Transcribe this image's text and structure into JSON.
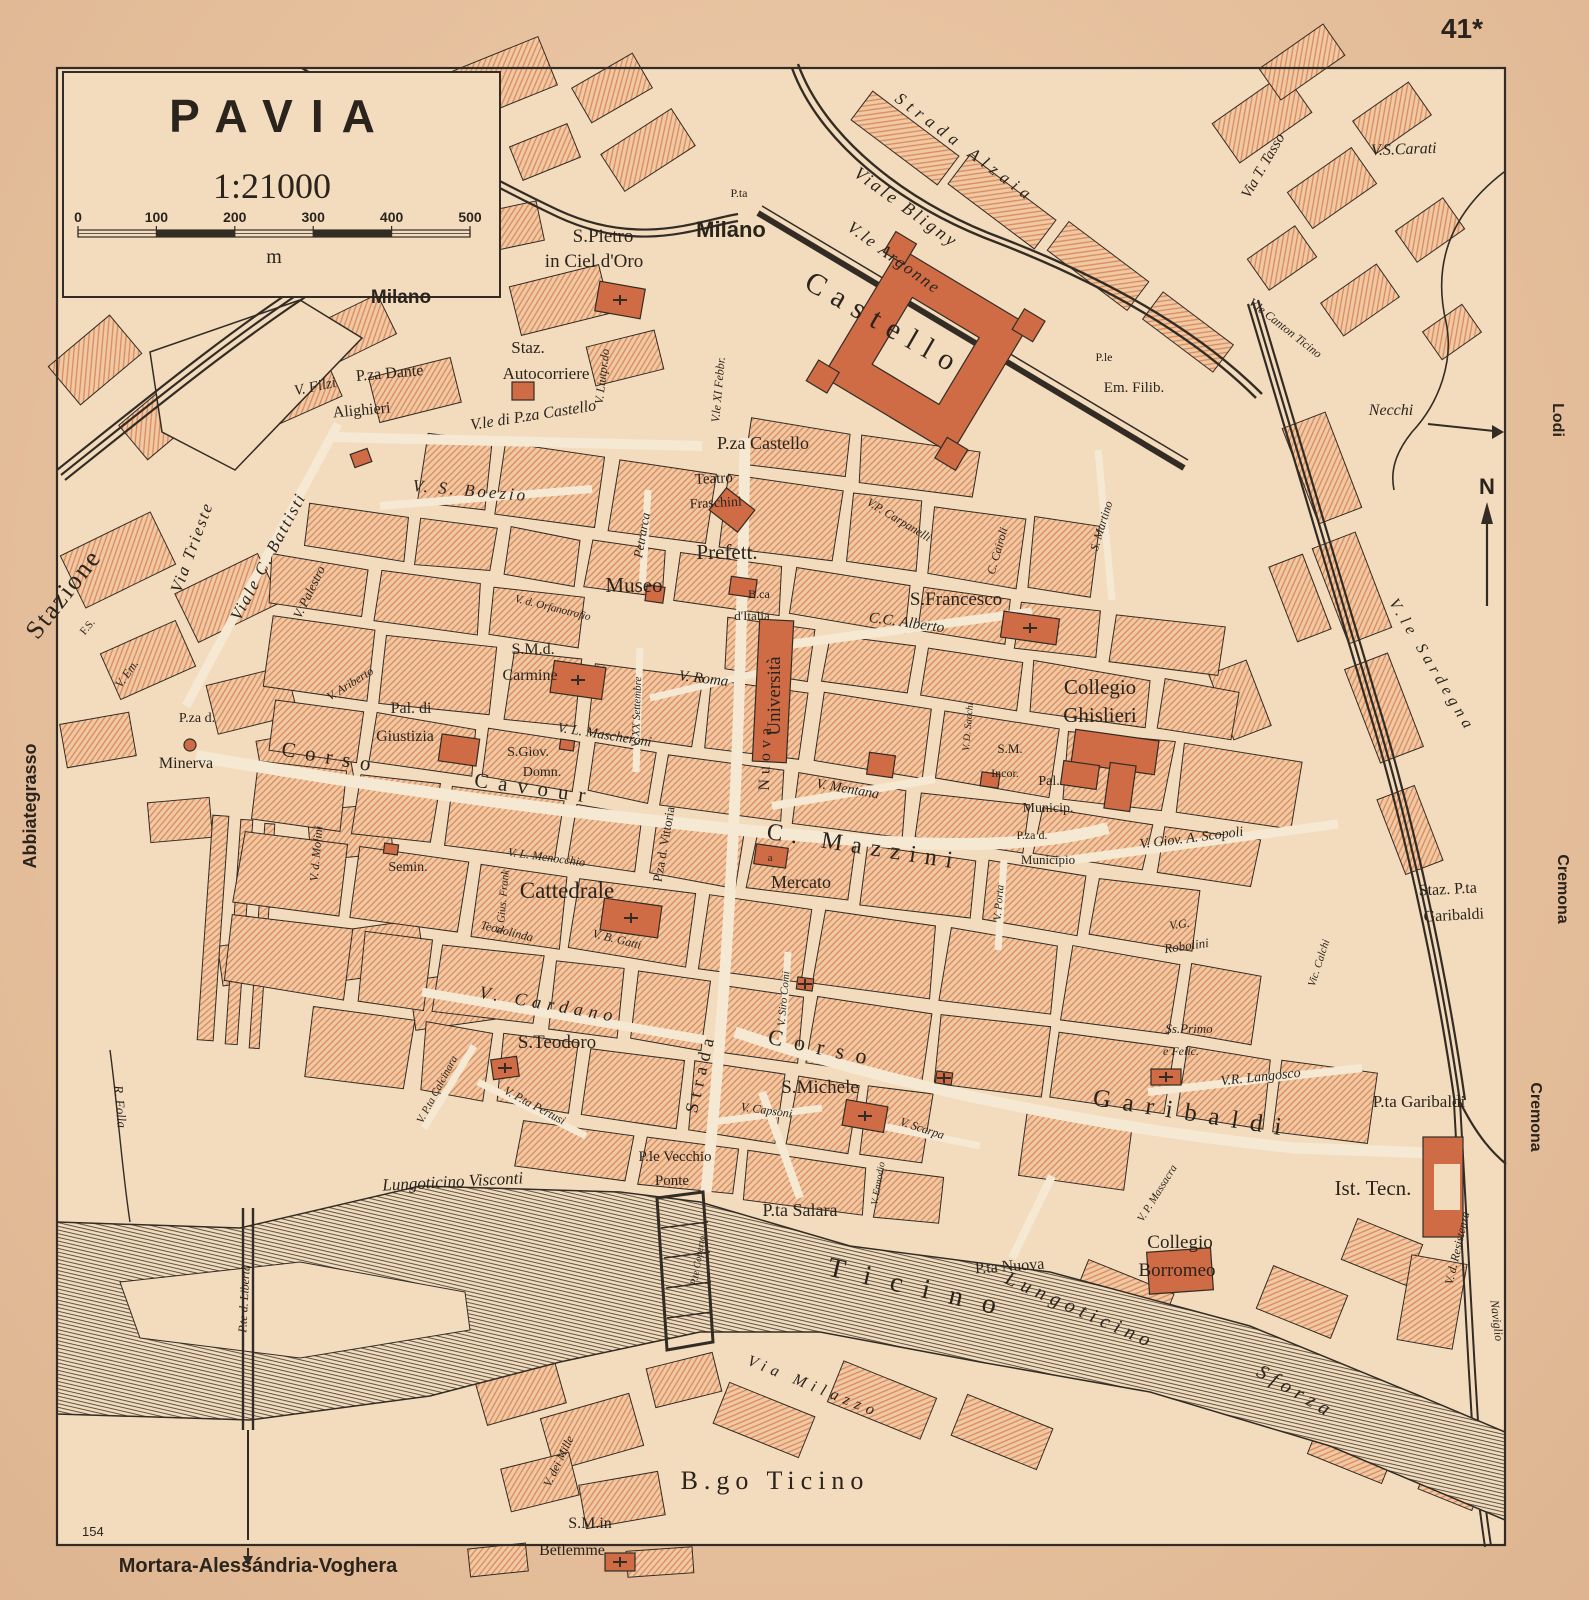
{
  "page": {
    "number": "41*",
    "plate": "154",
    "bottom_caption": "Mortara-Alessándria-Voghera"
  },
  "title_box": {
    "city": "PAVIA",
    "scale": "1:21000",
    "unit": "m",
    "ticks": [
      "0",
      "100",
      "200",
      "300",
      "400",
      "500"
    ]
  },
  "compass": {
    "north": "N"
  },
  "colors": {
    "paper": "#ecc4a0",
    "map_bg": "#f3dcbe",
    "street": "#f6e9d4",
    "block_fill": "#f0c9a4",
    "block_hatch": "#d98a5c",
    "building": "#cf6c46",
    "ink": "#332c24",
    "water_line": "#4a4236"
  },
  "map_labels": [
    {
      "t": "S.Pietro",
      "x": 603,
      "y": 242,
      "s": 19,
      "c": "place"
    },
    {
      "t": "in Ciel d'Oro",
      "x": 594,
      "y": 267,
      "s": 19,
      "c": "place"
    },
    {
      "t": "P.ta",
      "x": 739,
      "y": 197,
      "s": 12,
      "c": "place"
    },
    {
      "t": "Milano",
      "x": 731,
      "y": 237,
      "s": 22,
      "c": "exit"
    },
    {
      "t": "Strada Alzaia",
      "x": 962,
      "y": 152,
      "r": 37,
      "s": 17,
      "c": "street",
      "ls": 6
    },
    {
      "t": "Viale Bligny",
      "x": 903,
      "y": 212,
      "r": 36,
      "s": 18,
      "c": "street",
      "ls": 3
    },
    {
      "t": "V.le Argonne",
      "x": 891,
      "y": 262,
      "r": 36,
      "s": 17,
      "c": "street",
      "ls": 2
    },
    {
      "t": "Castello",
      "x": 880,
      "y": 332,
      "r": 30,
      "s": 30,
      "c": "place",
      "ls": 10
    },
    {
      "t": "V. Liutpr.do",
      "x": 606,
      "y": 377,
      "r": -83,
      "s": 12,
      "c": "street"
    },
    {
      "t": "V.le XI Febbr.",
      "x": 722,
      "y": 390,
      "r": -85,
      "s": 12,
      "c": "street"
    },
    {
      "t": "Staz.",
      "x": 528,
      "y": 353,
      "s": 17,
      "c": "place"
    },
    {
      "t": "Autocorriere",
      "x": 546,
      "y": 379,
      "s": 17,
      "c": "place"
    },
    {
      "t": "P.za Dante",
      "x": 390,
      "y": 378,
      "r": -5,
      "s": 16,
      "c": "place"
    },
    {
      "t": "Alighieri",
      "x": 362,
      "y": 415,
      "r": -5,
      "s": 16,
      "c": "place"
    },
    {
      "t": "V. Filzi",
      "x": 316,
      "y": 391,
      "r": -12,
      "s": 15,
      "c": "street"
    },
    {
      "t": "V.le di P.za Castello",
      "x": 534,
      "y": 420,
      "r": -9,
      "s": 16,
      "c": "street"
    },
    {
      "t": "P.za Castello",
      "x": 763,
      "y": 449,
      "s": 18,
      "c": "place"
    },
    {
      "t": "P.le",
      "x": 1104,
      "y": 361,
      "s": 12,
      "c": "place"
    },
    {
      "t": "Em. Filib.",
      "x": 1134,
      "y": 392,
      "s": 15,
      "c": "place"
    },
    {
      "t": "V.S.Carati",
      "x": 1404,
      "y": 154,
      "r": -2,
      "s": 16,
      "c": "street"
    },
    {
      "t": "Via T. Tasso",
      "x": 1267,
      "y": 168,
      "r": -60,
      "s": 15,
      "c": "street"
    },
    {
      "t": "V.le Canton Ticino",
      "x": 1283,
      "y": 331,
      "r": 38,
      "s": 12,
      "c": "street"
    },
    {
      "t": "Necchi",
      "x": 1391,
      "y": 415,
      "s": 16,
      "c": "street"
    },
    {
      "t": "Via Trieste",
      "x": 197,
      "y": 549,
      "r": -70,
      "s": 17,
      "c": "street",
      "ls": 2
    },
    {
      "t": "Stazione",
      "x": 70,
      "y": 599,
      "r": -52,
      "s": 26,
      "c": "place",
      "ls": 2
    },
    {
      "t": "F.S.",
      "x": 90,
      "y": 629,
      "r": -50,
      "s": 11,
      "c": "place"
    },
    {
      "t": "Viale C. Battisti",
      "x": 273,
      "y": 559,
      "r": -62,
      "s": 17,
      "c": "street",
      "ls": 2
    },
    {
      "t": "V. Palestro",
      "x": 313,
      "y": 594,
      "r": -64,
      "s": 13,
      "c": "street"
    },
    {
      "t": "V. S. Boezio",
      "x": 470,
      "y": 496,
      "r": 5,
      "s": 17,
      "c": "street",
      "ls": 3
    },
    {
      "t": "Teatro",
      "x": 714,
      "y": 483,
      "r": -3,
      "s": 15,
      "c": "place"
    },
    {
      "t": "Fraschini",
      "x": 716,
      "y": 507,
      "r": -3,
      "s": 14,
      "c": "place"
    },
    {
      "t": "Prefett.",
      "x": 727,
      "y": 559,
      "s": 21,
      "c": "place"
    },
    {
      "t": "Museo",
      "x": 634,
      "y": 592,
      "s": 21,
      "c": "place"
    },
    {
      "t": "B.ca",
      "x": 759,
      "y": 598,
      "s": 12,
      "c": "place"
    },
    {
      "t": "d'Italia",
      "x": 752,
      "y": 620,
      "s": 13,
      "c": "place"
    },
    {
      "t": "Petrarca",
      "x": 646,
      "y": 536,
      "r": -80,
      "s": 13,
      "c": "street"
    },
    {
      "t": "V.P. Carpanelli",
      "x": 897,
      "y": 523,
      "r": 31,
      "s": 12,
      "c": "street"
    },
    {
      "t": "C. Cairoli",
      "x": 1001,
      "y": 552,
      "r": -74,
      "s": 12,
      "c": "street"
    },
    {
      "t": "S.Francesco",
      "x": 956,
      "y": 605,
      "s": 19,
      "c": "place"
    },
    {
      "t": "C.C. Alberto",
      "x": 906,
      "y": 627,
      "r": 8,
      "s": 15,
      "c": "street"
    },
    {
      "t": "S. Martino",
      "x": 1105,
      "y": 527,
      "r": -73,
      "s": 12,
      "c": "street"
    },
    {
      "t": "Collegio",
      "x": 1100,
      "y": 694,
      "s": 21,
      "c": "place"
    },
    {
      "t": "Ghislieri",
      "x": 1100,
      "y": 722,
      "s": 21,
      "c": "place"
    },
    {
      "t": "V.le Sardegna",
      "x": 1428,
      "y": 668,
      "r": 59,
      "s": 16,
      "c": "street",
      "ls": 5
    },
    {
      "t": "Università",
      "x": 780,
      "y": 696,
      "r": -90,
      "s": 19,
      "c": "place"
    },
    {
      "t": "V. Roma",
      "x": 703,
      "y": 683,
      "r": 7,
      "s": 15,
      "c": "street"
    },
    {
      "t": "V. XX Settembre",
      "x": 640,
      "y": 712,
      "r": -88,
      "s": 11,
      "c": "street"
    },
    {
      "t": "S.M.d.",
      "x": 533,
      "y": 654,
      "s": 16,
      "c": "place"
    },
    {
      "t": "Carmine",
      "x": 530,
      "y": 680,
      "s": 16,
      "c": "place"
    },
    {
      "t": "V. L. Mascheroni",
      "x": 604,
      "y": 739,
      "r": 9,
      "s": 14,
      "c": "street"
    },
    {
      "t": "Pal. di",
      "x": 411,
      "y": 713,
      "s": 16,
      "c": "place"
    },
    {
      "t": "Giustizia",
      "x": 405,
      "y": 741,
      "s": 16,
      "c": "place"
    },
    {
      "t": "S.Giov.",
      "x": 528,
      "y": 756,
      "s": 14,
      "c": "place"
    },
    {
      "t": "Domn.",
      "x": 542,
      "y": 776,
      "s": 14,
      "c": "place"
    },
    {
      "t": "V. Ariberto",
      "x": 352,
      "y": 687,
      "r": -32,
      "s": 12,
      "c": "street"
    },
    {
      "t": "V. d. Molini",
      "x": 320,
      "y": 854,
      "r": -85,
      "s": 12,
      "c": "street"
    },
    {
      "t": "Corso",
      "x": 330,
      "y": 764,
      "r": 10,
      "s": 21,
      "c": "place",
      "ls": 10
    },
    {
      "t": "Cavour",
      "x": 534,
      "y": 795,
      "r": 8,
      "s": 21,
      "c": "place",
      "ls": 10
    },
    {
      "t": "P.za d.",
      "x": 197,
      "y": 722,
      "s": 14,
      "c": "place"
    },
    {
      "t": "Minerva",
      "x": 186,
      "y": 768,
      "s": 16,
      "c": "place"
    },
    {
      "t": "V. Em.",
      "x": 130,
      "y": 676,
      "r": -55,
      "s": 12,
      "c": "street"
    },
    {
      "t": "Abbiategrasso",
      "x": 36,
      "y": 806,
      "r": -90,
      "s": 18,
      "c": "exit"
    },
    {
      "t": "V. Gius. Frank",
      "x": 506,
      "y": 902,
      "r": -85,
      "s": 11,
      "c": "street"
    },
    {
      "t": "V. L. Menocchio",
      "x": 546,
      "y": 861,
      "r": 8,
      "s": 12,
      "c": "street"
    },
    {
      "t": "Semin.",
      "x": 408,
      "y": 871,
      "s": 14,
      "c": "place"
    },
    {
      "t": "Cattedrale",
      "x": 567,
      "y": 898,
      "s": 23,
      "c": "place"
    },
    {
      "t": "Teodolinda",
      "x": 506,
      "y": 935,
      "r": 14,
      "s": 12,
      "c": "street"
    },
    {
      "t": "V. B. Gatti",
      "x": 616,
      "y": 943,
      "r": 14,
      "s": 12,
      "c": "street"
    },
    {
      "t": "P.za d. Vittoria",
      "x": 668,
      "y": 845,
      "r": -80,
      "s": 13,
      "c": "place"
    },
    {
      "t": "V. Mentana",
      "x": 847,
      "y": 793,
      "r": 10,
      "s": 14,
      "c": "street"
    },
    {
      "t": "C. Mazzini",
      "x": 863,
      "y": 854,
      "r": 9,
      "s": 24,
      "c": "place",
      "ls": 9
    },
    {
      "t": "Mercato",
      "x": 801,
      "y": 888,
      "s": 18,
      "c": "place"
    },
    {
      "t": "a",
      "x": 770,
      "y": 861,
      "s": 11,
      "c": "place",
      "col": "#f6e9d4"
    },
    {
      "t": "V. Siro Comi",
      "x": 787,
      "y": 999,
      "r": -85,
      "s": 11,
      "c": "street"
    },
    {
      "t": "V. Porta",
      "x": 1002,
      "y": 903,
      "r": -85,
      "s": 11,
      "c": "street"
    },
    {
      "t": "S.M.",
      "x": 1010,
      "y": 753,
      "s": 13,
      "c": "place"
    },
    {
      "t": "Incor.",
      "x": 1005,
      "y": 777,
      "s": 12,
      "c": "place"
    },
    {
      "t": "Pal.",
      "x": 1049,
      "y": 785,
      "s": 14,
      "c": "place"
    },
    {
      "t": "Municip.",
      "x": 1048,
      "y": 812,
      "s": 14,
      "c": "place"
    },
    {
      "t": "P.za d.",
      "x": 1032,
      "y": 839,
      "s": 12,
      "c": "place"
    },
    {
      "t": "Municipio",
      "x": 1048,
      "y": 864,
      "s": 13,
      "c": "place"
    },
    {
      "t": "V. Giov. A. Scopoli",
      "x": 1192,
      "y": 842,
      "r": -7,
      "s": 14,
      "c": "street"
    },
    {
      "t": "V. D. Sacchi",
      "x": 971,
      "y": 727,
      "r": -85,
      "s": 10,
      "c": "street"
    },
    {
      "t": "V.G.",
      "x": 1180,
      "y": 928,
      "r": -8,
      "s": 12,
      "c": "street"
    },
    {
      "t": "Robolini",
      "x": 1187,
      "y": 950,
      "r": -8,
      "s": 13,
      "c": "street"
    },
    {
      "t": "Vic. Calchi",
      "x": 1322,
      "y": 964,
      "r": -72,
      "s": 11,
      "c": "street"
    },
    {
      "t": "Staz. P.ta",
      "x": 1448,
      "y": 894,
      "r": -3,
      "s": 16,
      "c": "place"
    },
    {
      "t": "Garibaldi",
      "x": 1454,
      "y": 920,
      "r": -3,
      "s": 16,
      "c": "place"
    },
    {
      "t": "Ss.Primo",
      "x": 1189,
      "y": 1033,
      "s": 13,
      "c": "street"
    },
    {
      "t": "e Felic.",
      "x": 1181,
      "y": 1055,
      "s": 12,
      "c": "street"
    },
    {
      "t": "V.R. Langosco",
      "x": 1261,
      "y": 1081,
      "r": -6,
      "s": 14,
      "c": "street"
    },
    {
      "t": "P.ta Garibaldi",
      "x": 1419,
      "y": 1107,
      "s": 17,
      "c": "place"
    },
    {
      "t": "Ist. Tecn.",
      "x": 1373,
      "y": 1195,
      "s": 21,
      "c": "place"
    },
    {
      "t": "Garibaldi",
      "x": 1192,
      "y": 1121,
      "r": 9,
      "s": 25,
      "c": "place",
      "ls": 12
    },
    {
      "t": "Corso",
      "x": 822,
      "y": 1055,
      "r": 12,
      "s": 22,
      "c": "place",
      "ls": 12
    },
    {
      "t": "S.Teodoro",
      "x": 557,
      "y": 1048,
      "s": 19,
      "c": "place"
    },
    {
      "t": "V. Cardano",
      "x": 548,
      "y": 1010,
      "r": 10,
      "s": 18,
      "c": "street",
      "ls": 6
    },
    {
      "t": "V. P.ta Calcinara",
      "x": 440,
      "y": 1091,
      "r": -62,
      "s": 11,
      "c": "street"
    },
    {
      "t": "V. P.ta Pertusi",
      "x": 533,
      "y": 1109,
      "r": 28,
      "s": 12,
      "c": "street"
    },
    {
      "t": "S.Michele",
      "x": 820,
      "y": 1093,
      "s": 19,
      "c": "place"
    },
    {
      "t": "V. Capsoni",
      "x": 766,
      "y": 1114,
      "r": 8,
      "s": 12,
      "c": "street"
    },
    {
      "t": "V. Scarpa",
      "x": 921,
      "y": 1132,
      "r": 18,
      "s": 12,
      "c": "street"
    },
    {
      "t": "V. Ennodio",
      "x": 881,
      "y": 1184,
      "r": -80,
      "s": 10,
      "c": "street"
    },
    {
      "t": "P.le Vecchio",
      "x": 675,
      "y": 1161,
      "s": 15,
      "c": "place"
    },
    {
      "t": "Ponte",
      "x": 672,
      "y": 1185,
      "s": 15,
      "c": "place"
    },
    {
      "t": "P.ta Salara",
      "x": 800,
      "y": 1216,
      "s": 18,
      "c": "place"
    },
    {
      "t": "Lungoticino Visconti",
      "x": 453,
      "y": 1187,
      "r": -3,
      "s": 17,
      "c": "street"
    },
    {
      "t": "P.te d. Libertà",
      "x": 248,
      "y": 1299,
      "r": -87,
      "s": 12,
      "c": "street"
    },
    {
      "t": "R. Folla",
      "x": 116,
      "y": 1107,
      "r": 85,
      "s": 13,
      "c": "street"
    },
    {
      "t": "P.te Coperto",
      "x": 701,
      "y": 1261,
      "r": -80,
      "s": 10,
      "c": "street"
    },
    {
      "t": "Ticino",
      "x": 920,
      "y": 1297,
      "r": 13,
      "s": 28,
      "c": "place",
      "ls": 20
    },
    {
      "t": "Lungoticino",
      "x": 1078,
      "y": 1316,
      "r": 24,
      "s": 20,
      "c": "street",
      "ls": 6
    },
    {
      "t": "Sforza",
      "x": 1293,
      "y": 1397,
      "r": 30,
      "s": 20,
      "c": "street",
      "ls": 6
    },
    {
      "t": "P.ta Nuova",
      "x": 1010,
      "y": 1271,
      "r": -4,
      "s": 16,
      "c": "place"
    },
    {
      "t": "V. P. Massacra",
      "x": 1160,
      "y": 1195,
      "r": -58,
      "s": 11,
      "c": "street"
    },
    {
      "t": "Collegio",
      "x": 1180,
      "y": 1248,
      "s": 19,
      "c": "place"
    },
    {
      "t": "Borromeo",
      "x": 1177,
      "y": 1276,
      "s": 19,
      "c": "place"
    },
    {
      "t": "V. d. Resistenza",
      "x": 1461,
      "y": 1249,
      "r": -77,
      "s": 12,
      "c": "street"
    },
    {
      "t": "Naviglio",
      "x": 1493,
      "y": 1321,
      "r": 83,
      "s": 12,
      "c": "street"
    },
    {
      "t": "Cremona",
      "x": 1558,
      "y": 889,
      "r": 90,
      "s": 16,
      "c": "exit"
    },
    {
      "t": "Cremona",
      "x": 1531,
      "y": 1117,
      "r": 90,
      "s": 16,
      "c": "exit"
    },
    {
      "t": "Lodi",
      "x": 1553,
      "y": 420,
      "r": 90,
      "s": 16,
      "c": "exit"
    },
    {
      "t": "Via Milazzo",
      "x": 812,
      "y": 1391,
      "r": 22,
      "s": 16,
      "c": "street",
      "ls": 6
    },
    {
      "t": "B.go Ticino",
      "x": 775,
      "y": 1489,
      "s": 26,
      "c": "place",
      "ls": 6
    },
    {
      "t": "V. dei Mille",
      "x": 562,
      "y": 1463,
      "r": -64,
      "s": 12,
      "c": "street"
    },
    {
      "t": "S.M.in",
      "x": 590,
      "y": 1528,
      "s": 16,
      "c": "place"
    },
    {
      "t": "Betlemme",
      "x": 572,
      "y": 1555,
      "s": 16,
      "c": "place"
    },
    {
      "t": "Milano",
      "x": 401,
      "y": 303,
      "s": 19,
      "c": "exit"
    },
    {
      "t": "V. d. Orfanotrofio",
      "x": 552,
      "y": 611,
      "r": 14,
      "s": 11,
      "c": "street"
    },
    {
      "t": "Strada",
      "x": 706,
      "y": 1074,
      "r": -77,
      "s": 18,
      "c": "place",
      "ls": 6
    },
    {
      "t": "Nuova",
      "x": 770,
      "y": 757,
      "r": -88,
      "s": 16,
      "c": "place",
      "ls": 5
    }
  ]
}
